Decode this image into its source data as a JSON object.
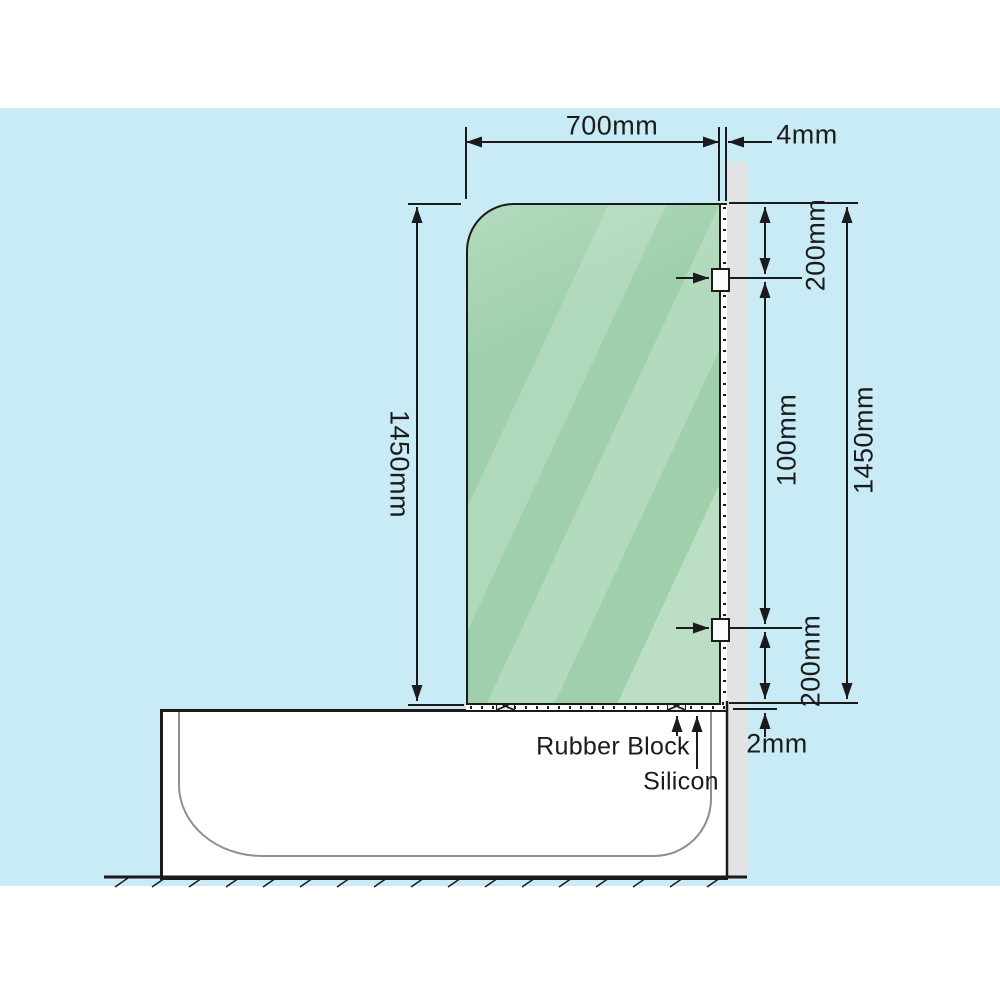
{
  "figure": {
    "type": "installation-diagram",
    "subject": "Frameless glass shower screen panel fixed to wall above bathtub - side elevation",
    "dimensions": {
      "glass_width": "700mm",
      "glass_wall_gap": "4mm",
      "glass_height_left": "1450mm",
      "bracket_top_offset": "200mm",
      "bracket_spacing": "100mm",
      "glass_height_right": "1450mm",
      "bracket_bottom_offset": "200mm",
      "base_gap": "2mm"
    },
    "callouts": {
      "rubber_block": "Rubber Block",
      "silicon": "Silicon"
    },
    "colors": {
      "background": "#c9ebf5",
      "glass": "#9fd0ab",
      "wall": "#e3e3e3",
      "line": "#1b1b1b",
      "tub_inner_line": "#8f8f8f"
    }
  }
}
